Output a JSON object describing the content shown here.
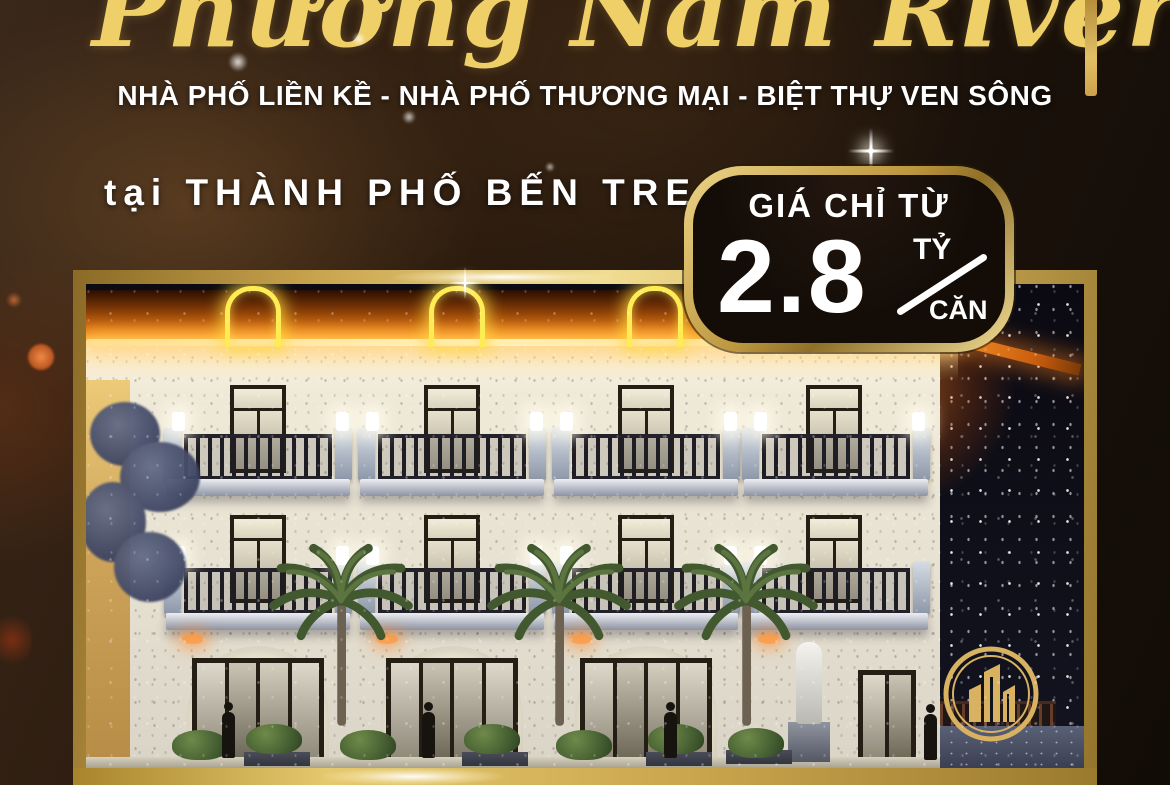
{
  "title": "Phương Nam River Park",
  "subtitle": "NHÀ PHỐ LIỀN KỀ - NHÀ PHỐ THƯƠNG MẠI - BIỆT THỰ VEN SÔNG",
  "location": "tại THÀNH PHỐ BẾN TRE",
  "price_badge": {
    "label": "GIÁ CHỈ TỪ",
    "amount": "2.8",
    "unit_numerator": "TỶ",
    "unit_denominator": "CĂN"
  },
  "icons": {
    "logo": "gold-towers-in-double-circle",
    "sparkle": "four-point-star",
    "neon_arch": "glowing-arch"
  },
  "colors": {
    "gold": "#d8b25a",
    "gold_light": "#f0dc92",
    "gold_dark": "#8a6a26",
    "title_gold": "#efcf68",
    "badge_background": "#140d07",
    "neon_yellow": "#ffec55",
    "led_orange": "#f08a1c",
    "text_white": "#ffffff",
    "background_brown": "#2b1b0e",
    "night_sky": "#0c0b13"
  }
}
